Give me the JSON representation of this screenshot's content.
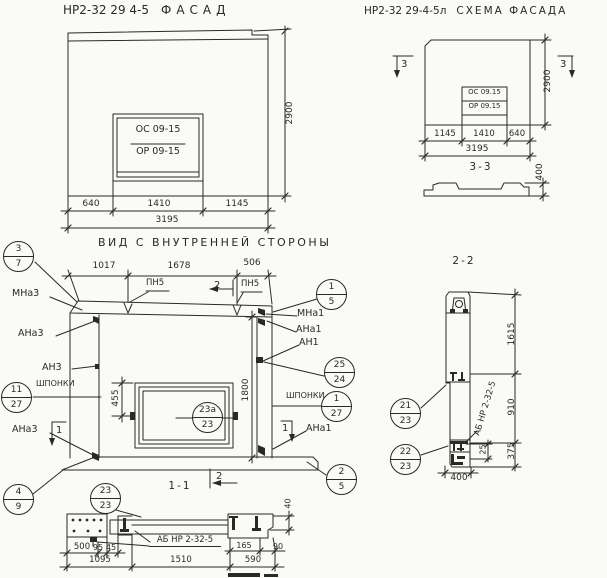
{
  "facade": {
    "title_code": "НР2-32 29 4-5",
    "title_word": "ФАСАД",
    "window_top": "ОС 09-15",
    "window_bottom": "ОР 09-15",
    "dim_left": "640",
    "dim_mid": "1410",
    "dim_right": "1145",
    "dim_total": "3195",
    "dim_height": "2900"
  },
  "scheme": {
    "title_code": "НР2-32 29-4-5л",
    "title_word": "СХЕМА ФАСАДА",
    "window_top": "ОС 09.15",
    "window_bottom": "ОР 09.15",
    "dim_left": "1145",
    "dim_mid": "1410",
    "dim_right": "640",
    "dim_total": "3195",
    "dim_height": "2900",
    "marker_left": "3",
    "marker_right": "3",
    "section_title": "3-3",
    "section_height": "400"
  },
  "inner": {
    "title": "ВИД С ВНУТРЕННЕЙ СТОРОНЫ",
    "dim_top_left": "1017",
    "dim_top_mid": "1678",
    "dim_top_right": "506",
    "dim_window_offset": "455",
    "dim_opening_height": "1800",
    "label_mna3": "МНа3",
    "label_ana3_top": "АНа3",
    "label_an3": "АН3",
    "label_shponki_left": "ШПОНКИ",
    "label_ana3_bottom": "АНа3",
    "label_mna1": "МНа1",
    "label_ana1_top": "АНа1",
    "label_an1": "АН1",
    "label_shponki_right": "ШПОНКИ",
    "label_ana1_bottom": "АНа1",
    "label_pn5_left": "ПН5",
    "label_pn5_right": "ПН5",
    "marker_2_top": "2",
    "marker_2_bottom": "2",
    "marker_1_left": "1",
    "marker_1_right": "1",
    "callout_37": {
      "top": "3",
      "bottom": "7"
    },
    "callout_15": {
      "top": "1",
      "bottom": "5"
    },
    "callout_2524": {
      "top": "25",
      "bottom": "24"
    },
    "callout_127": {
      "top": "1",
      "bottom": "27"
    },
    "callout_1127": {
      "top": "11",
      "bottom": "27"
    },
    "callout_25": {
      "top": "2",
      "bottom": "5"
    },
    "callout_49": {
      "top": "4",
      "bottom": "9"
    },
    "callout_23a": {
      "top": "23а",
      "bottom": "23"
    }
  },
  "sec11": {
    "title": "1-1",
    "part_label": "АБ НР 2-32-5",
    "callout_2323": {
      "top": "23",
      "bottom": "23"
    },
    "dim_500": "500",
    "dim_95": "95",
    "dim_45": "45",
    "dim_1095": "1095",
    "dim_1510": "1510",
    "dim_165": "165",
    "dim_90": "90",
    "dim_590": "590",
    "dim_40": "40"
  },
  "sec22": {
    "title": "2-2",
    "part_label": "АБ НР 2-32-5",
    "callout_2123": {
      "top": "21",
      "bottom": "23"
    },
    "callout_2223": {
      "top": "22",
      "bottom": "23"
    },
    "dim_1615": "1615",
    "dim_910": "910",
    "dim_375": "375",
    "dim_25": "25",
    "dim_400": "400"
  }
}
